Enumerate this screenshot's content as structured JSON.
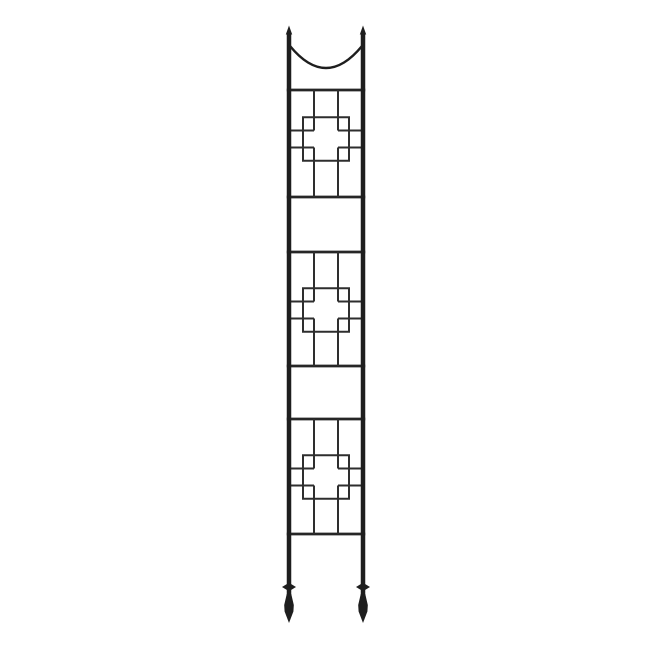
{
  "scene": {
    "description": "Product photo of a tall narrow black wrought-iron garden trellis on a plain white background",
    "background_color": "#ffffff"
  },
  "trellis": {
    "color_posts": "#1e1e1e",
    "color_rails": "#262626",
    "color_lattice": "#2e2e2e",
    "center_x": 326,
    "posts": {
      "left_x": 289,
      "right_x": 363,
      "width": 4.5,
      "top_y": 33,
      "shaft_bottom_y": 596,
      "finial_tip_y": 25.5,
      "finial_base_y": 34.5,
      "finial_base_half_w": 3.2
    },
    "arc": {
      "attach_y": 46,
      "control_y": 90,
      "stroke": 2.4
    },
    "rails": {
      "stroke": 2.7
    },
    "lattice": {
      "stroke": 2,
      "vbar_offset": 12,
      "hbar_offset": 8.5,
      "square_half_w": 23,
      "square_half_h": 21.75
    },
    "panels": [
      {
        "rail_top": 90,
        "rail_bottom": 197,
        "motif_cy": 139
      },
      {
        "rail_top": 252,
        "rail_bottom": 366,
        "motif_cy": 310
      },
      {
        "rail_top": 419,
        "rail_bottom": 534,
        "motif_cy": 477
      }
    ],
    "feet": {
      "collar_cy": 587,
      "collar_half_w": 7,
      "collar_half_h": 4.3,
      "spear_neck_y": 594,
      "spear_shoulder_y": 605,
      "spear_widest_y": 611.5,
      "spear_half_w": 4.8,
      "spear_tip_y": 623
    }
  }
}
